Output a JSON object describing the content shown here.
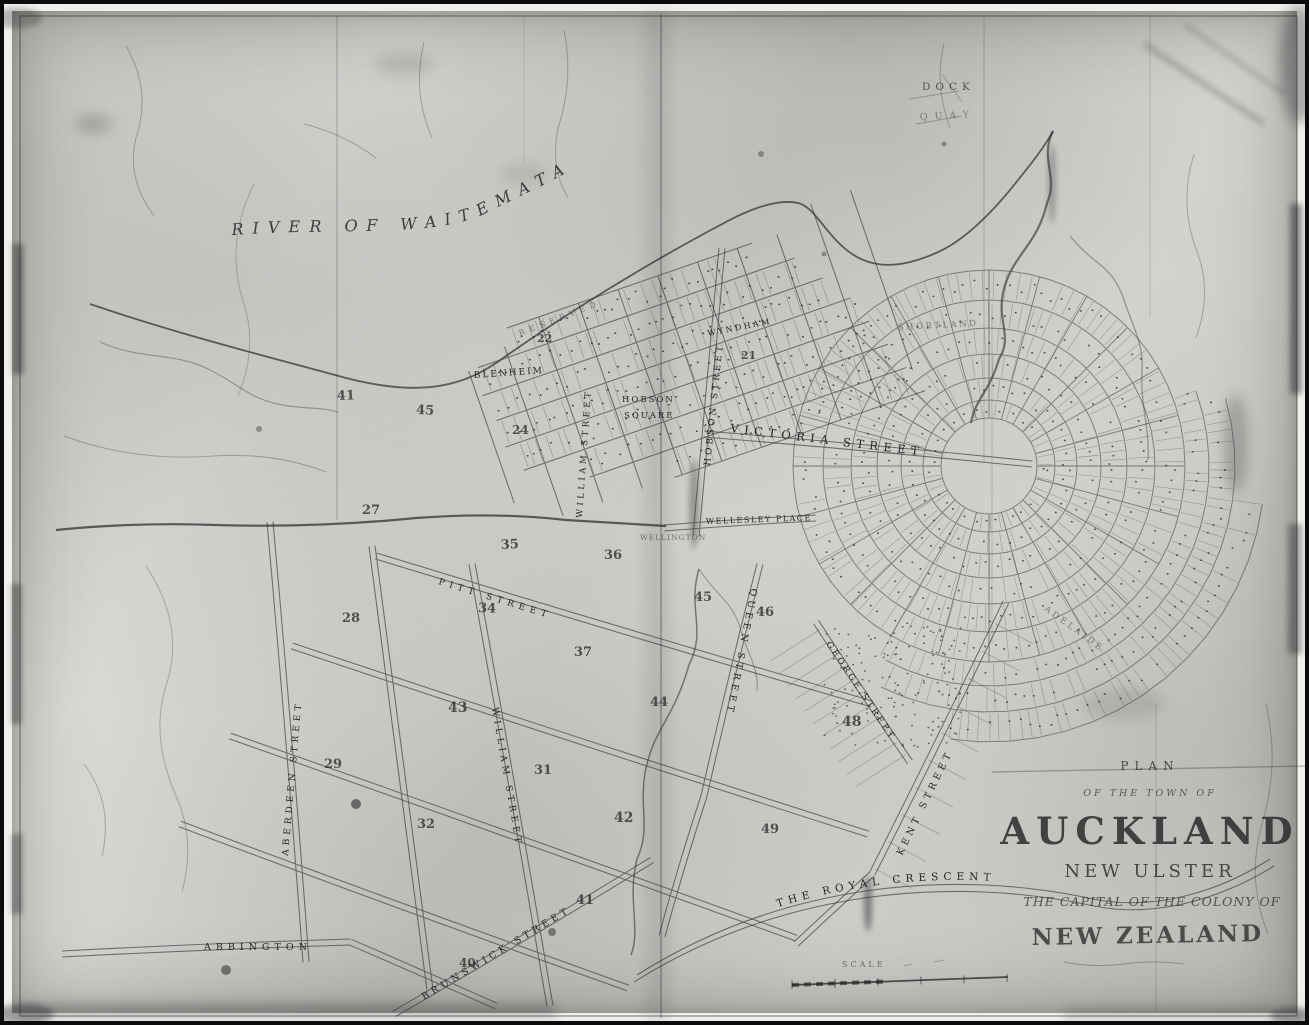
{
  "palette": {
    "ink": "#2a2a2a",
    "paper_light": "#dcdbd8",
    "paper_dark": "#c3c2bf"
  },
  "title_block": {
    "plan": "PLAN",
    "of_the_town_of": "OF THE TOWN OF",
    "city": "AUCKLAND",
    "province": "NEW ULSTER",
    "capital_line": "THE CAPITAL OF THE COLONY OF",
    "country": "NEW ZEALAND"
  },
  "water": {
    "river": "RIVER OF WAITEMATA",
    "dock": "DOCK",
    "quay": "QUAY"
  },
  "scale": {
    "label": "SCALE"
  },
  "streets": [
    {
      "id": "blenheim-street",
      "text": "BLENHEIM"
    },
    {
      "id": "william-street-north",
      "text": "WILLIAM STREET"
    },
    {
      "id": "hobson-street",
      "text": "HOBSON STREET"
    },
    {
      "id": "wyndham-street",
      "text": "WYNDHAM"
    },
    {
      "id": "victoria-street",
      "text": "VICTORIA STREET"
    },
    {
      "id": "shortland-crescent",
      "text": "SHORTLAND"
    },
    {
      "id": "hobson-square-line1",
      "text": "HOBSON"
    },
    {
      "id": "hobson-square-line2",
      "text": "SQUARE"
    },
    {
      "id": "wellesley-place",
      "text": "WELLESLEY PLACE"
    },
    {
      "id": "wellington",
      "text": "WELLINGTON"
    },
    {
      "id": "reserved-foreshore",
      "text": "RESERVED"
    },
    {
      "id": "queen-street",
      "text": "QUEEN STREET"
    },
    {
      "id": "pitt-street",
      "text": "PITT STREET"
    },
    {
      "id": "william-street-south",
      "text": "WILLIAM STREET"
    },
    {
      "id": "aberdeen-street",
      "text": "ABERDEEN STREET"
    },
    {
      "id": "george-street",
      "text": "GEORGE STREET"
    },
    {
      "id": "kent-street",
      "text": "KENT STREET"
    },
    {
      "id": "brunswick-street",
      "text": "BRUNSWICK STREET"
    },
    {
      "id": "abbington-road",
      "text": "ABBINGTON"
    },
    {
      "id": "royal-crescent",
      "text": "THE ROYAL CRESCENT"
    },
    {
      "id": "adelaide-crescent",
      "text": "ADELAIDE"
    }
  ],
  "blocks": [
    "41",
    "45",
    "24",
    "22",
    "21",
    "27",
    "35",
    "36",
    "28",
    "34",
    "37",
    "43",
    "44",
    "45",
    "46",
    "29",
    "31",
    "48",
    "32",
    "42",
    "49",
    "41",
    "40"
  ]
}
